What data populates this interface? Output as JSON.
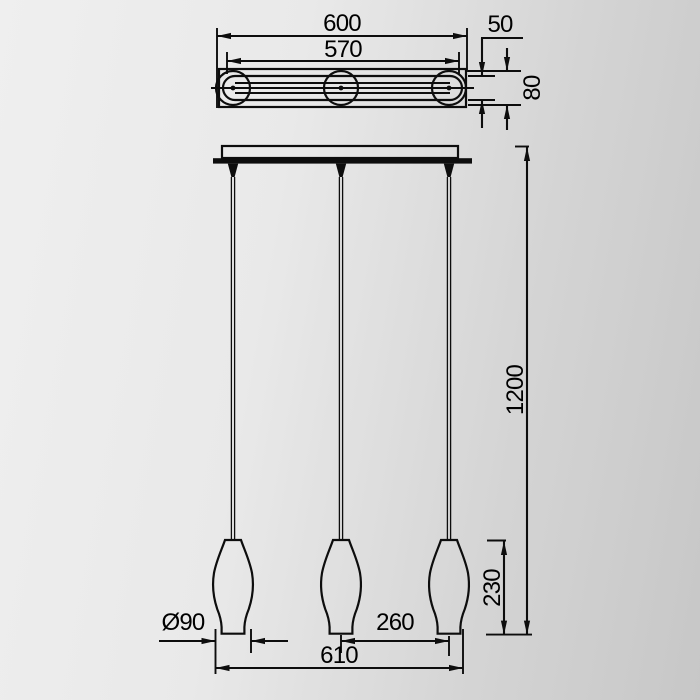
{
  "drawing_type": "pendant-lamp-dimension-drawing",
  "colors": {
    "line": "#0d0d0d",
    "background_left": "#efefef",
    "background_right": "#c7c7c7"
  },
  "top_view": {
    "outer_width": "600",
    "inner_width": "570",
    "bar_depth": "50",
    "canopy_height": "80"
  },
  "front_view": {
    "suspension_height": "1200",
    "shade_height": "230",
    "shade_diameter": "Ø90",
    "shade_spacing": "260",
    "overall_width": "610"
  }
}
